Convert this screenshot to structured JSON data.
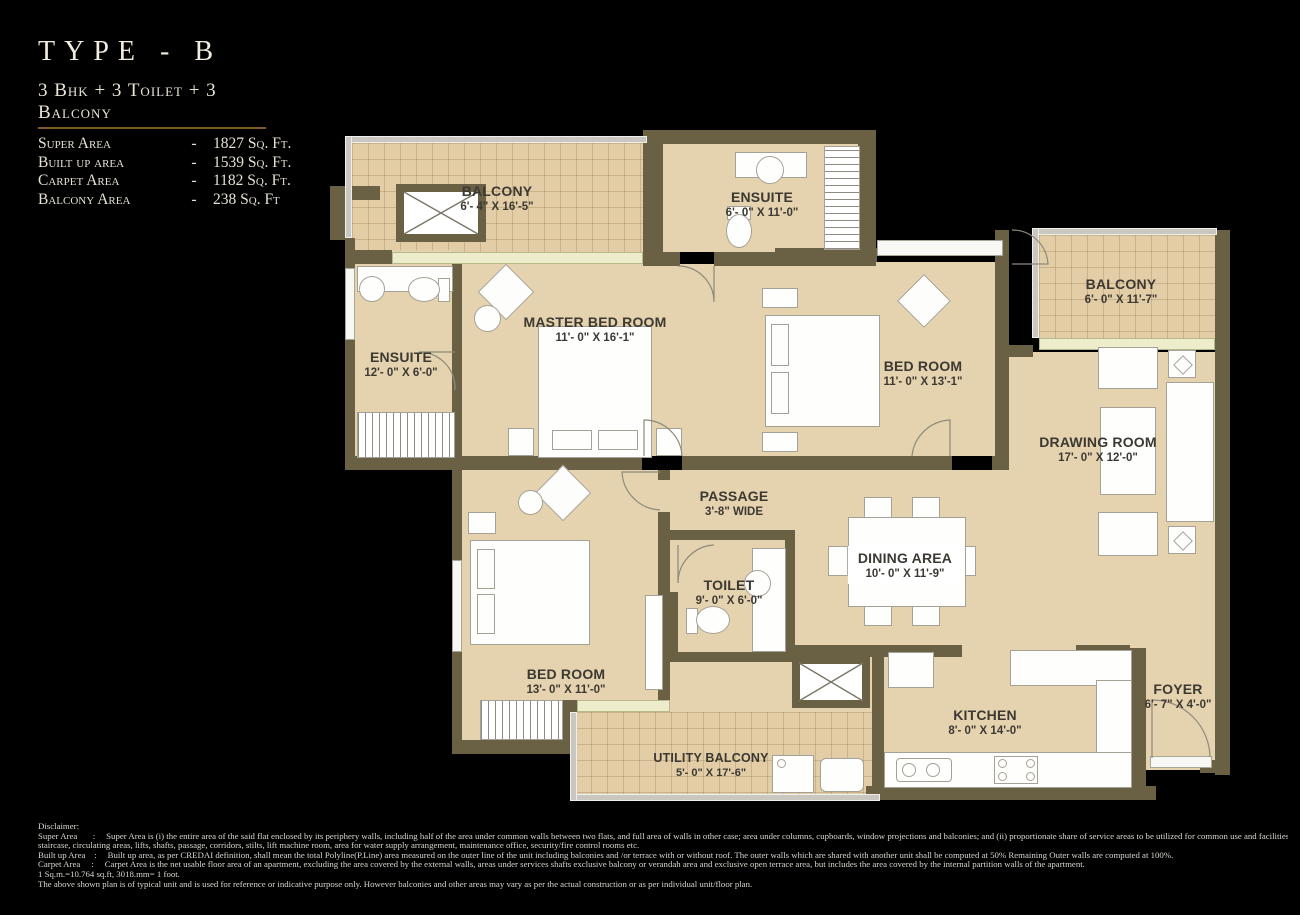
{
  "header": {
    "title": "TYPE - B",
    "subtitle": "3 Bhk + 3 Toilet + 3 Balcony",
    "areas": [
      {
        "label": "Super Area",
        "sep": "-",
        "value": "1827 Sq. Ft."
      },
      {
        "label": "Built up area",
        "sep": "-",
        "value": "1539 Sq. Ft."
      },
      {
        "label": "Carpet Area",
        "sep": "-",
        "value": "1182 Sq. Ft."
      },
      {
        "label": "Balcony Area",
        "sep": "-",
        "value": "238 Sq. Ft"
      }
    ]
  },
  "rooms": {
    "balcony_top": {
      "name": "BALCONY",
      "dims": "6'- 4\" X 16'-5\""
    },
    "ensuite_top": {
      "name": "ENSUITE",
      "dims": "6'- 0\" X 11'-0\""
    },
    "ensuite_left": {
      "name": "ENSUITE",
      "dims": "12'- 0\" X 6'-0\""
    },
    "master_bedroom": {
      "name": "MASTER BED ROOM",
      "dims": "11'- 0\" X 16'-1\""
    },
    "bedroom_right": {
      "name": "BED ROOM",
      "dims": "11'- 0\" X 13'-1\""
    },
    "balcony_right": {
      "name": "BALCONY",
      "dims": "6'- 0\" X 11'-7\""
    },
    "drawing_room": {
      "name": "DRAWING ROOM",
      "dims": "17'- 0\" X 12'-0\""
    },
    "passage": {
      "name": "PASSAGE",
      "dims": "3'-8\" WIDE"
    },
    "toilet": {
      "name": "TOILET",
      "dims": "9'- 0\" X 6'-0\""
    },
    "dining": {
      "name": "DINING AREA",
      "dims": "10'- 0\" X 11'-9\""
    },
    "bedroom_bottom": {
      "name": "BED ROOM",
      "dims": "13'- 0\" X 11'-0\""
    },
    "utility_balcony": {
      "name": "UTILITY BALCONY",
      "dims": "5'- 0\" X 17'-6\""
    },
    "kitchen": {
      "name": "KITCHEN",
      "dims": "8'- 0\" X 14'-0\""
    },
    "foyer": {
      "name": "FOYER",
      "dims": "6'- 7\" X 4'-0\""
    }
  },
  "disclaimer": {
    "lines": [
      "Disclaimer:",
      "Super Area       :     Super Area is (i) the entire area of the said flat enclosed by its periphery walls, including half of the area under common walls between two flats, and full area of walls in other case; area under columns, cupboards, window projections and balconies; and (ii) proportionate share of service areas to be utilized for common use and facilities, including but not limited to lobbies,",
      "staircase, circulating areas, lifts, shafts, passage, corridors, stilts, lift machine room, area for water supply arrangement, maintenance office, security/fire control rooms etc.",
      "Built up Area    :     Built up area, as per CREDAI definition, shall mean the total Polyline(P.Line) area measured on the outer line of the unit including balconies and /or terrace with or without roof. The outer walls which are shared with another unit shall be computed at 50% Remaining Outer walls are computed at 100%.",
      "Carpet Area     :     Carpet Area is the net usable floor area of an apartment, excluding the area covered by the external walls, areas under services shafts exclusive balcony or verandah area and exclusive open terrace area, but includes the area covered by the internal partition walls of the apartment.",
      "1 Sq.m.=10.764 sq.ft, 3018.mm= 1 foot.",
      "The above shown plan is of typical unit and is used for reference or indicative purpose only. However balconies and other areas may vary as per the actual construction or as per individual unit/floor plan."
    ]
  },
  "colors": {
    "background": "#000000",
    "floor": "#e5d2ae",
    "balcony_floor": "#e2cda6",
    "wall": "#6a6145",
    "accent_underline": "#7d5a23",
    "label_text": "#3c3933",
    "title_text": "#efeadb"
  }
}
